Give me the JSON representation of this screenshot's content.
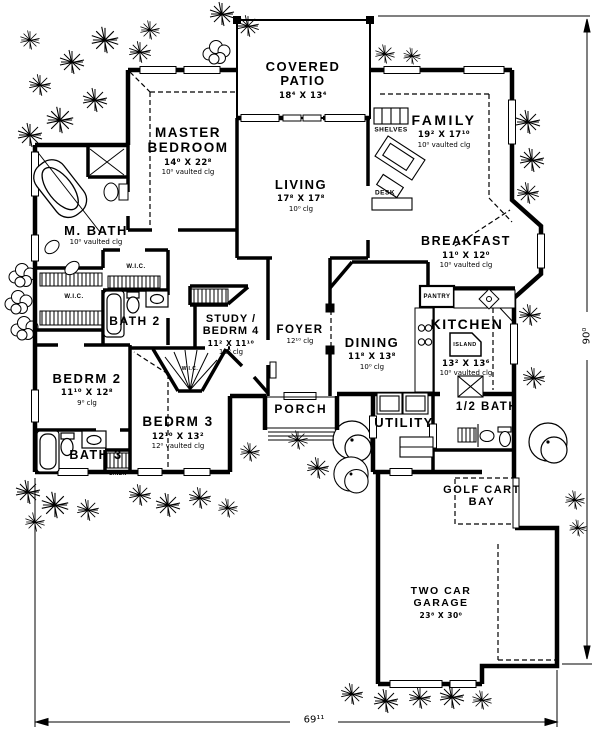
{
  "rooms": {
    "covered_patio": {
      "name": "COVERED PATIO",
      "dims": "18⁴ X 13⁴"
    },
    "master_bedroom": {
      "name": "MASTER BEDROOM",
      "dims": "14⁰ X 22⁸",
      "ceiling": "10⁰ vaulted clg"
    },
    "living": {
      "name": "LIVING",
      "dims": "17⁸ X 17⁸",
      "ceiling": "10⁰ clg"
    },
    "family": {
      "name": "FAMILY",
      "dims": "19² X 17¹⁰",
      "ceiling": "10⁰ vaulted clg"
    },
    "breakfast": {
      "name": "BREAKFAST",
      "dims": "11⁰ X 12⁰",
      "ceiling": "10⁰ vaulted clg"
    },
    "master_bath": {
      "name": "M. BATH",
      "ceiling": "10⁰ vaulted clg"
    },
    "bath2": {
      "name": "BATH 2"
    },
    "study": {
      "name": "STUDY / BEDRM 4",
      "dims": "11² X 11¹⁰",
      "ceiling": "10⁰ clg"
    },
    "foyer": {
      "name": "FOYER",
      "ceiling": "12¹⁰ clg"
    },
    "dining": {
      "name": "DINING",
      "dims": "11⁸ X 13⁸",
      "ceiling": "10⁰ clg"
    },
    "kitchen": {
      "name": "KITCHEN",
      "dims": "13² X 13⁶",
      "ceiling": "10⁰ vaulted clg"
    },
    "bedrm2": {
      "name": "BEDRM 2",
      "dims": "11¹⁰ X 12⁸",
      "ceiling": "9⁰ clg"
    },
    "bedrm3": {
      "name": "BEDRM 3",
      "dims": "12¹⁰ X 13²",
      "ceiling": "12⁰ vaulted clg"
    },
    "bath3": {
      "name": "BATH 3"
    },
    "porch": {
      "name": "PORCH"
    },
    "utility": {
      "name": "UTILITY"
    },
    "half_bath": {
      "name": "1/2 BATH"
    },
    "golf_cart_bay": {
      "name": "GOLF CART BAY"
    },
    "garage": {
      "name": "TWO CAR GARAGE",
      "dims": "23⁸ X 30⁰"
    }
  },
  "features": {
    "shelves": "SHELVES",
    "desk": "DESK",
    "pantry": "PANTRY",
    "island": "ISLAND",
    "wic_hall": "W.I.C.",
    "wic_master": "W.I.C.",
    "wic_bedrm3": "W.I.C.",
    "linen": "LINEN"
  },
  "dimensions": {
    "overall_width": "69¹¹",
    "overall_depth": "90⁰"
  },
  "colors": {
    "line": "#000000",
    "background": "#ffffff"
  }
}
